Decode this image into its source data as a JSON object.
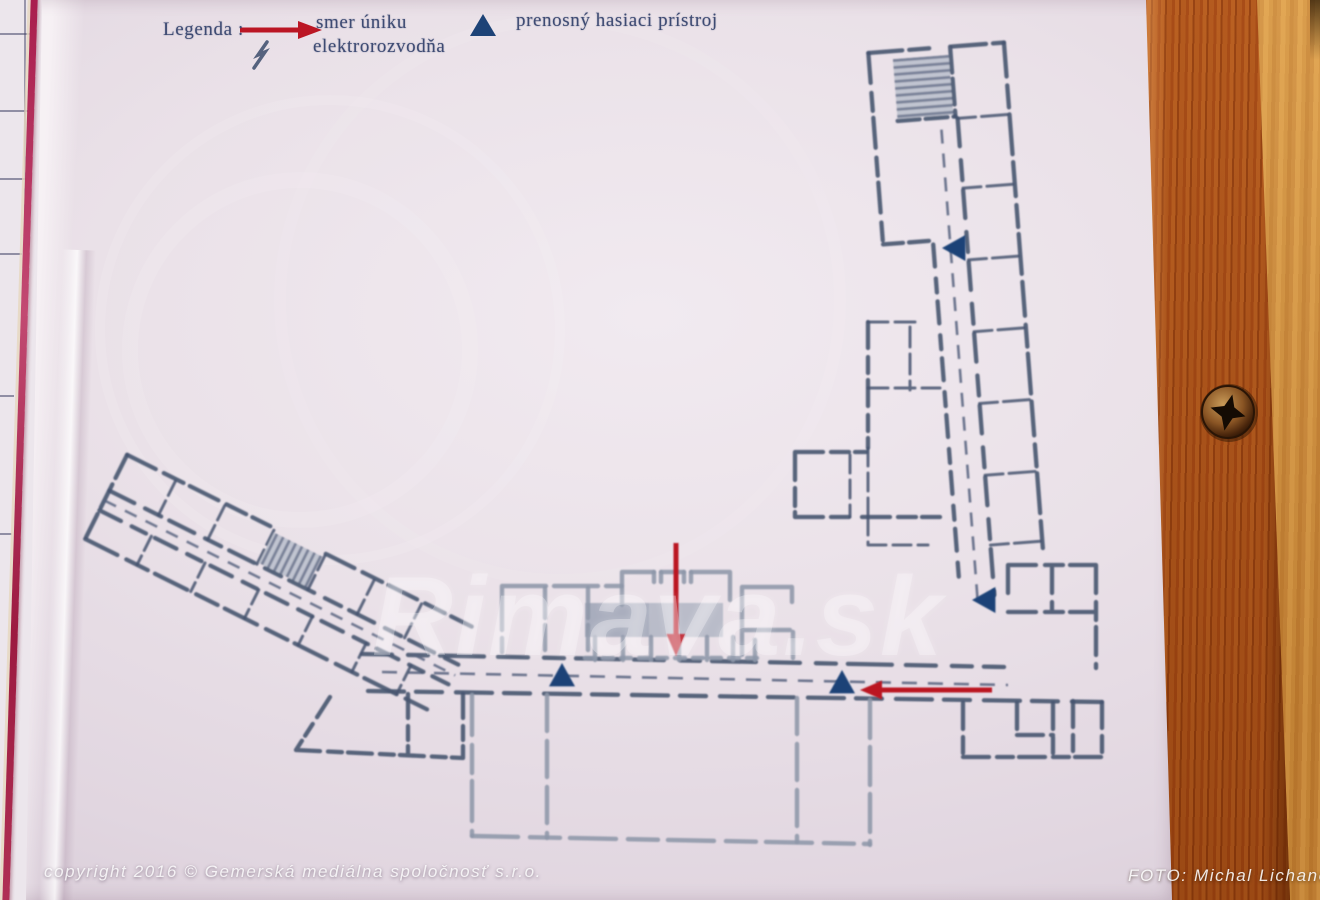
{
  "legend": {
    "title": "Legenda :",
    "items": [
      {
        "icon": "escape-arrow",
        "label": "smer úniku"
      },
      {
        "icon": "electrical-room",
        "label": "elektrorozvodňa"
      },
      {
        "icon": "fire-extinguisher",
        "label": "prenosný hasiaci prístroj"
      }
    ]
  },
  "watermark": "Rimava.sk",
  "footer": {
    "copyright": "copyright 2016  ©  Gemerská mediálna spoločnosť s.r.o.",
    "photo_credit": "FOTO: Michal Lichanec"
  },
  "colors": {
    "escape_arrow": "#bb1624",
    "extinguisher": "#1d4377",
    "plan_ink": "#46546f",
    "plan_faded": "#8d96a8",
    "paper": "#eae1e8",
    "wood_dark": "#a5521c",
    "wood_light": "#cf9140",
    "red_stripe": "#a81c4c"
  },
  "plan": {
    "markers": {
      "extinguishers": [
        {
          "x": 955,
          "y": 248,
          "dir": "left"
        },
        {
          "x": 985,
          "y": 600,
          "dir": "left"
        },
        {
          "x": 562,
          "y": 676,
          "dir": "up"
        },
        {
          "x": 842,
          "y": 683,
          "dir": "up"
        }
      ],
      "escape_arrows": [
        {
          "x1": 676,
          "y1": 543,
          "x2": 676,
          "y2": 634,
          "dir": "down"
        },
        {
          "x1": 992,
          "y1": 690,
          "x2": 882,
          "y2": 690,
          "dir": "left"
        }
      ]
    }
  }
}
